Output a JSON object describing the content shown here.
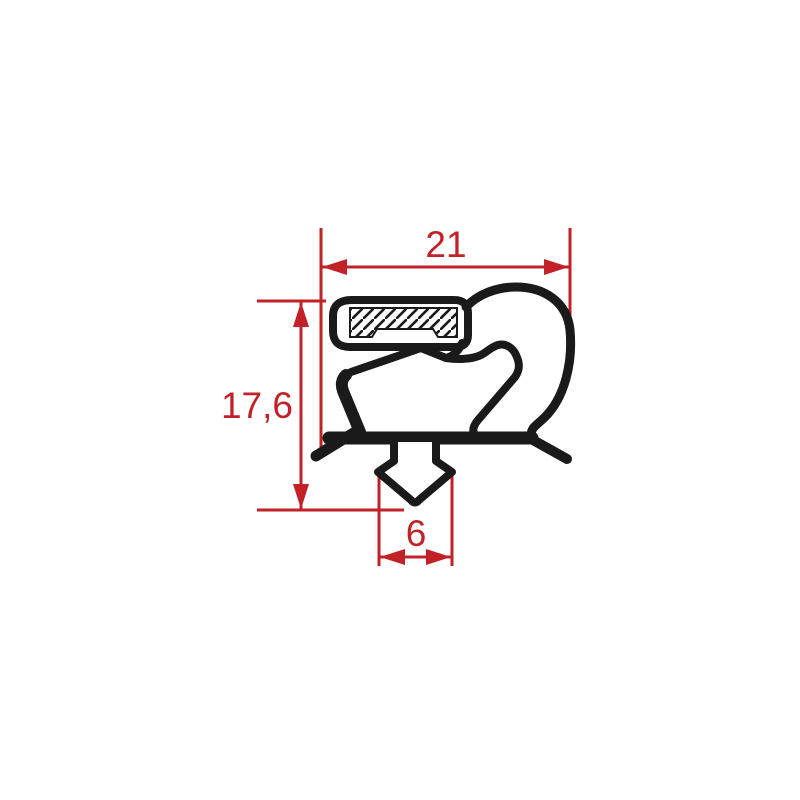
{
  "drawing": {
    "kind": "gasket-profile-cross-section",
    "colors": {
      "dimension": "#c22127",
      "profile": "#1a1a1a",
      "background": "#ffffff"
    },
    "dimensions": {
      "overall_width": {
        "label": "21"
      },
      "overall_height": {
        "label": "17,6"
      },
      "dart_width": {
        "label": "6"
      }
    }
  }
}
